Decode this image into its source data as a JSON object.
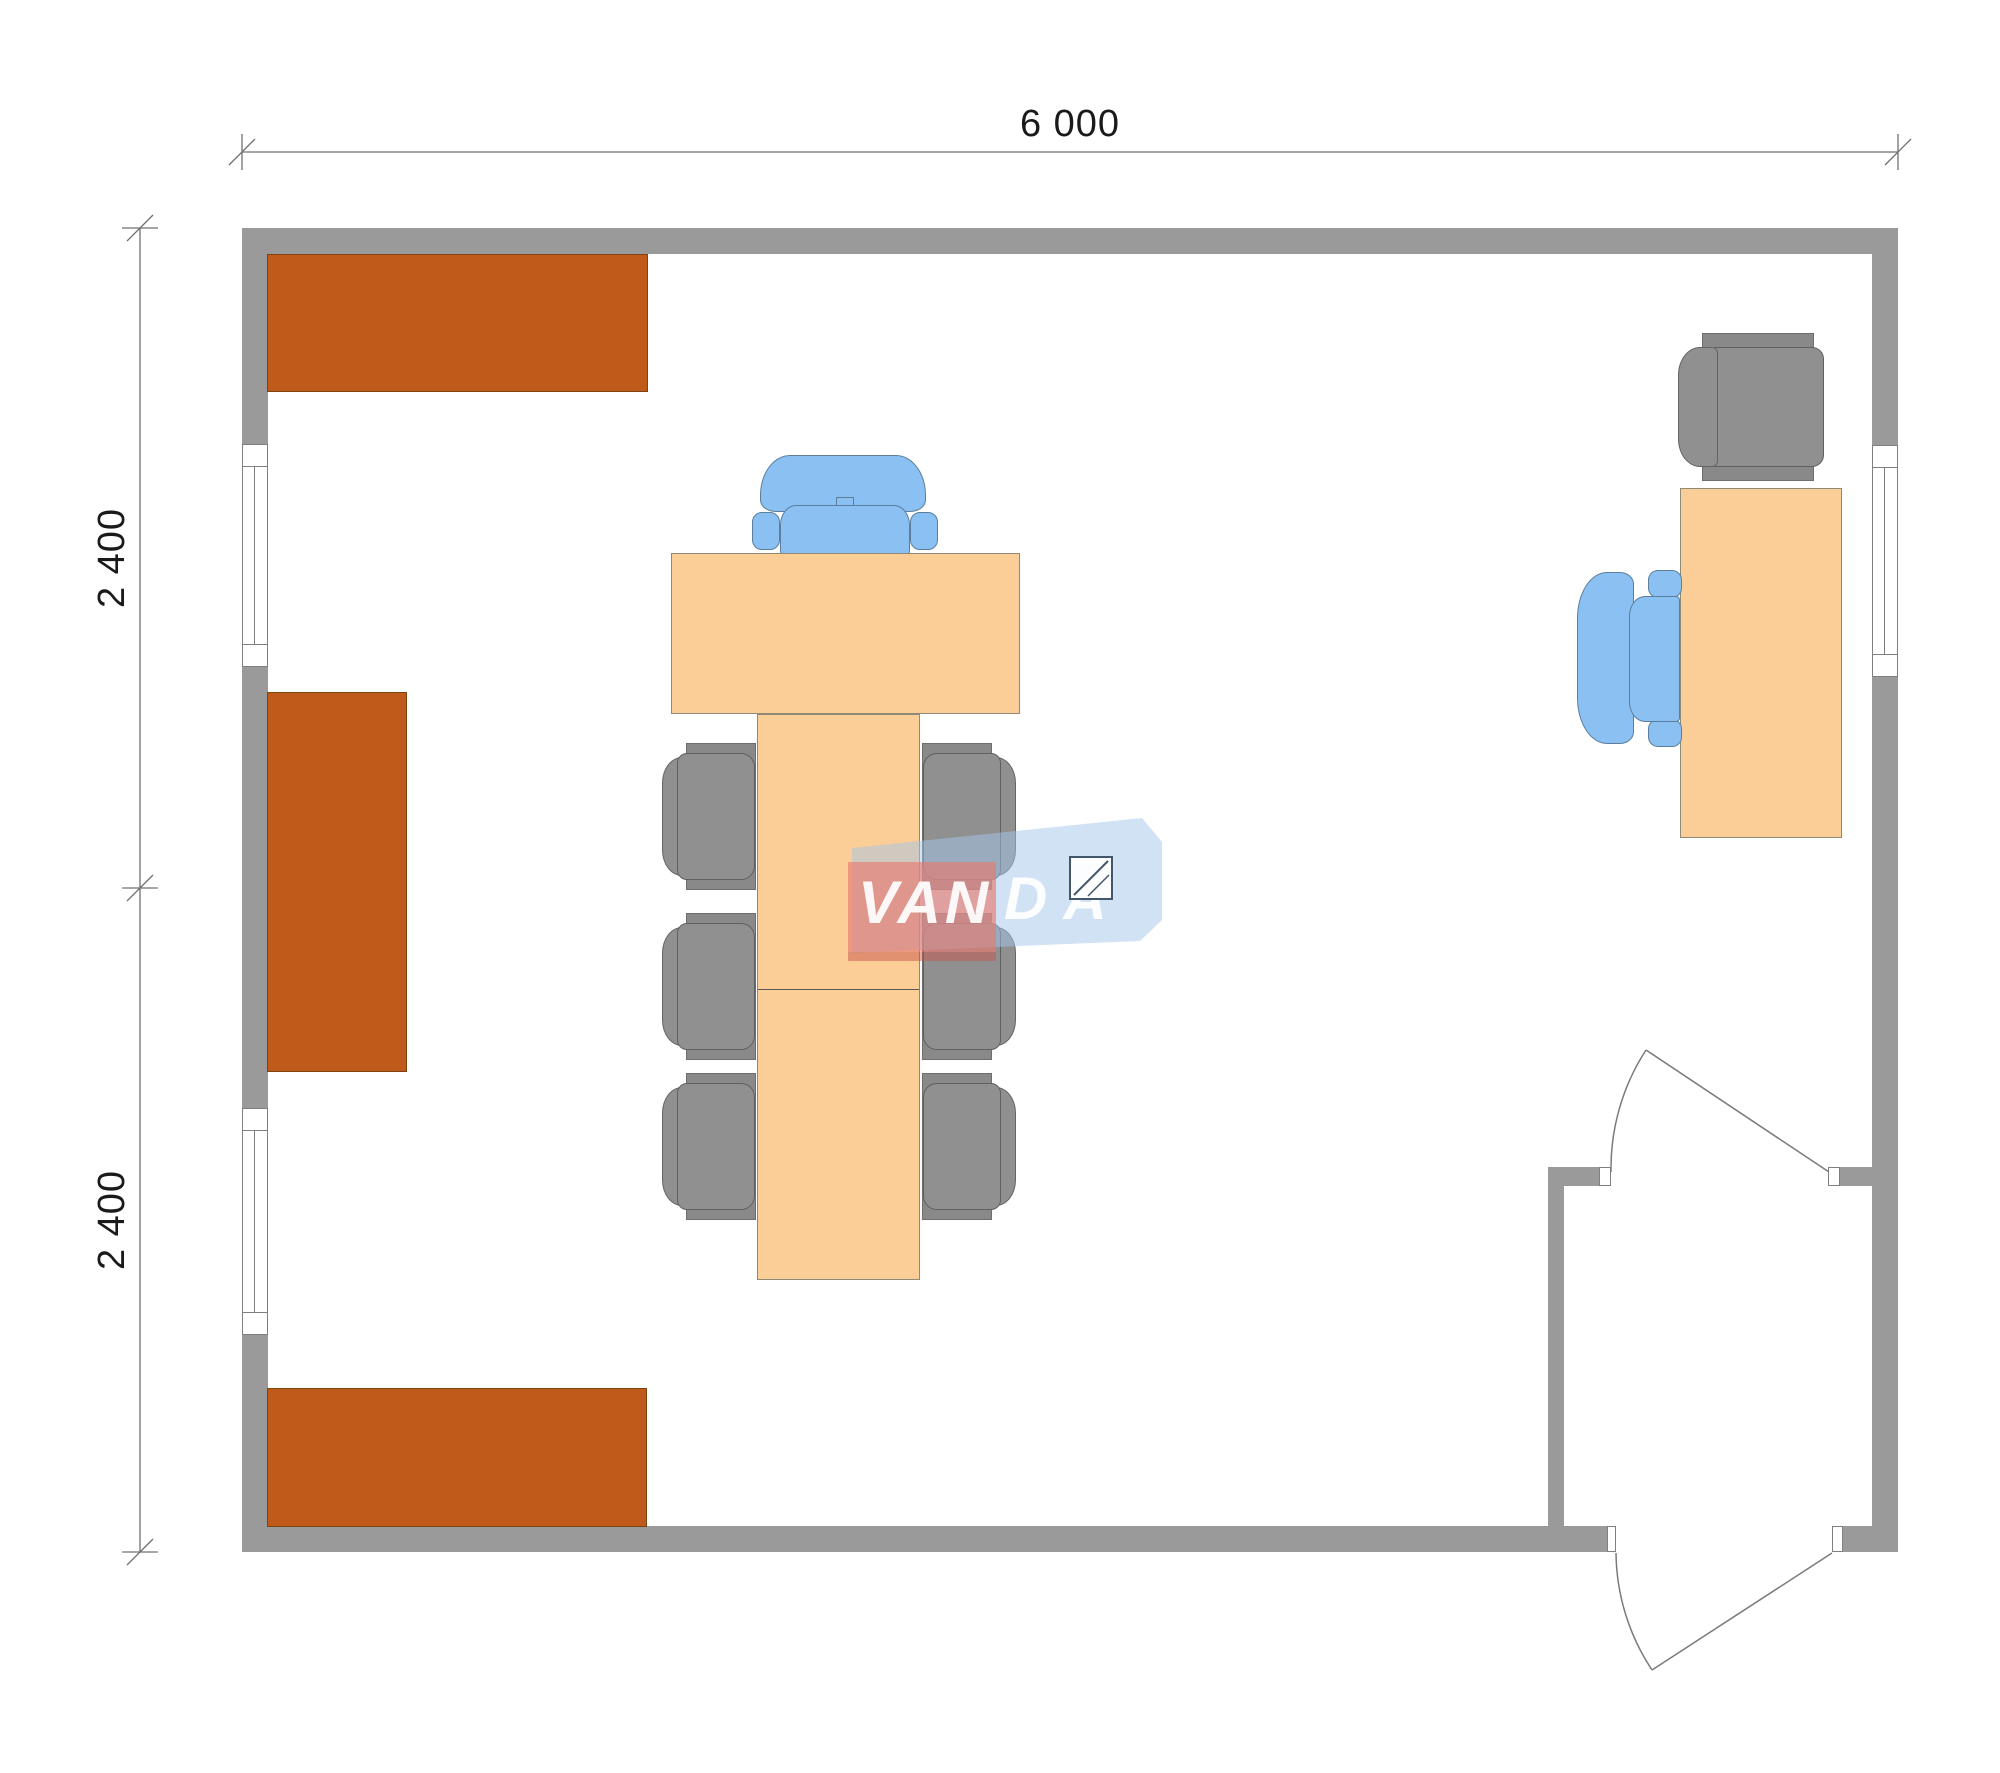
{
  "dimensions": {
    "top": "6 000",
    "left_upper": "2 400",
    "left_lower": "2 400"
  },
  "watermark": {
    "text_left": "VAN",
    "text_right": "DA"
  },
  "colors": {
    "wall": "#9A9A9A",
    "cabinet": "#C05A1B",
    "cabinetBorder": "#7E430F",
    "desk": "#FBCD97",
    "deskBorder": "#8E8A76",
    "chair": "#909090",
    "chairDark": "#898989",
    "chairBorder": "#5F5F5F",
    "blue": "#8AC1F2",
    "blueBorder": "#5B7E9C",
    "dimLine": "#707070",
    "dimText": "#1A1A1A",
    "frame": "#7F7F7F",
    "wmRed": "#E9776C",
    "wmRedDark": "#C8544A",
    "wmBlue": "#A3C6EA",
    "wmSquareBorder": "#44566B"
  }
}
